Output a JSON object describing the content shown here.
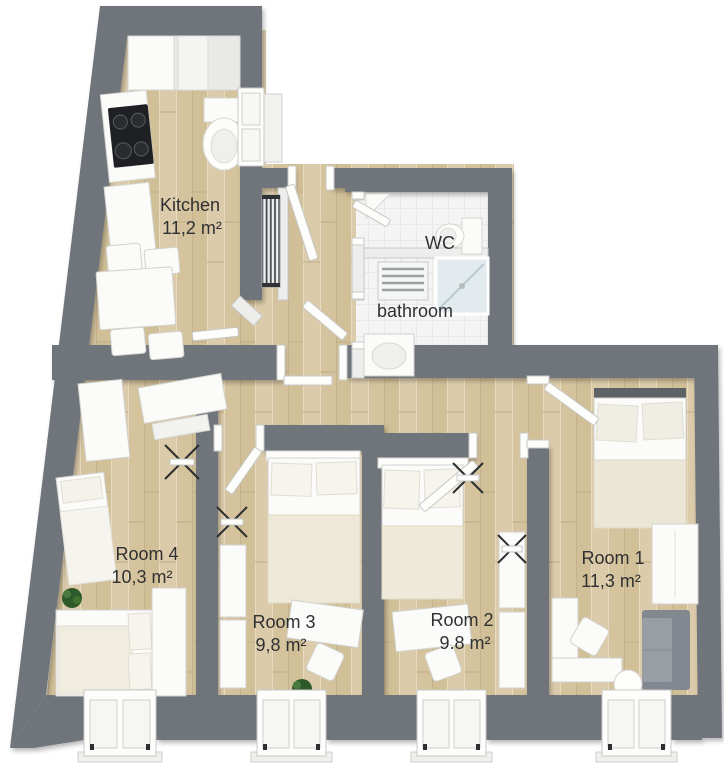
{
  "floorplan": {
    "type": "3d-apartment-floor-plan",
    "labels": {
      "kitchen": {
        "name": "Kitchen",
        "area": "11,2 m²"
      },
      "wc": {
        "name": "WC"
      },
      "bathroom": {
        "name": "bathroom"
      },
      "room1": {
        "name": "Room 1",
        "area": "11,3 m²"
      },
      "room2": {
        "name": "Room 2",
        "area": "9.8 m²"
      },
      "room3": {
        "name": "Room 3",
        "area": "9,8 m²"
      },
      "room4": {
        "name": "Room 4",
        "area": "10,3 m²"
      }
    },
    "colors": {
      "wall": "#6f757b",
      "wood_floor": "#d7c5a1",
      "tile_floor": "#f3f4f3",
      "furniture": "#fbfbf9",
      "duvet": "#ece6d6",
      "sofa": "#82888f",
      "plant": "#2e5a2b",
      "cooktop": "#1f2023",
      "text": "#2f3032"
    },
    "fixtures": {
      "kitchen": [
        "counter",
        "cooktop",
        "toilet",
        "window",
        "dining-table",
        "chairs"
      ],
      "hall": [
        "entry-door",
        "radiator",
        "kitchen-door",
        "bathroom-door"
      ],
      "wc": [
        "toilet",
        "corner-shelf",
        "door"
      ],
      "bathroom": [
        "towel-radiator",
        "shower",
        "washbasin"
      ],
      "room1": [
        "bed",
        "wardrobe",
        "desk",
        "chair",
        "sofa",
        "round-table",
        "window",
        "door"
      ],
      "room2": [
        "bed",
        "wardrobe",
        "desk",
        "chair",
        "window",
        "door",
        "drying-rack"
      ],
      "room3": [
        "bed",
        "wardrobe",
        "desk",
        "chair",
        "plant",
        "window",
        "door",
        "drying-rack"
      ],
      "room4": [
        "wardrobe",
        "desk",
        "single-bed",
        "double-bed",
        "plant",
        "window",
        "drying-rack"
      ]
    }
  }
}
